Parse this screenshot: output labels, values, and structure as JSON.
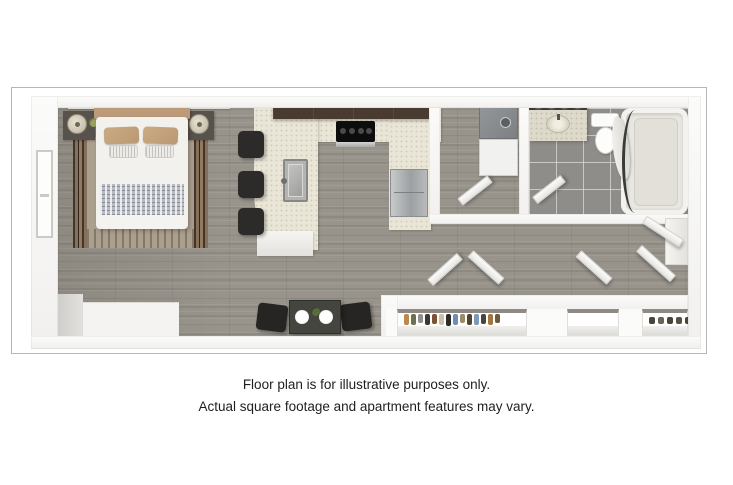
{
  "disclaimer": {
    "line1": "Floor plan is for illustrative purposes only.",
    "line2": "Actual square footage and apartment features may vary."
  },
  "floor_plan": {
    "type": "studio-apartment-3d-top-view",
    "rooms": [
      "bedroom-living-area",
      "kitchen",
      "laundry-closet",
      "bathroom",
      "hallway",
      "closets",
      "entry"
    ],
    "furniture": [
      "bed",
      "nightstand-with-lamp-left",
      "nightstand-with-lamp-right",
      "area-rug",
      "bar-stools-x3",
      "kitchen-sink",
      "cooktop",
      "refrigerator",
      "stacked-washer-dryer",
      "bathroom-vanity-with-lights",
      "toilet",
      "bathtub-with-shower-curtain",
      "dining-table-with-two-chairs",
      "hanging-clothes",
      "shoe-shelf"
    ],
    "colors": {
      "wood_floor": "#98948c",
      "bathroom_tile": "#8e8d89",
      "countertop": "#e9e5d7",
      "upper_cabinets": "#4a3b30",
      "accent_tan": "#bb9b79",
      "dark_furniture": "#2c2b29",
      "wall": "#f7f6f4",
      "frame_border": "#b7b6b3",
      "text": "#1f1f1f"
    }
  }
}
